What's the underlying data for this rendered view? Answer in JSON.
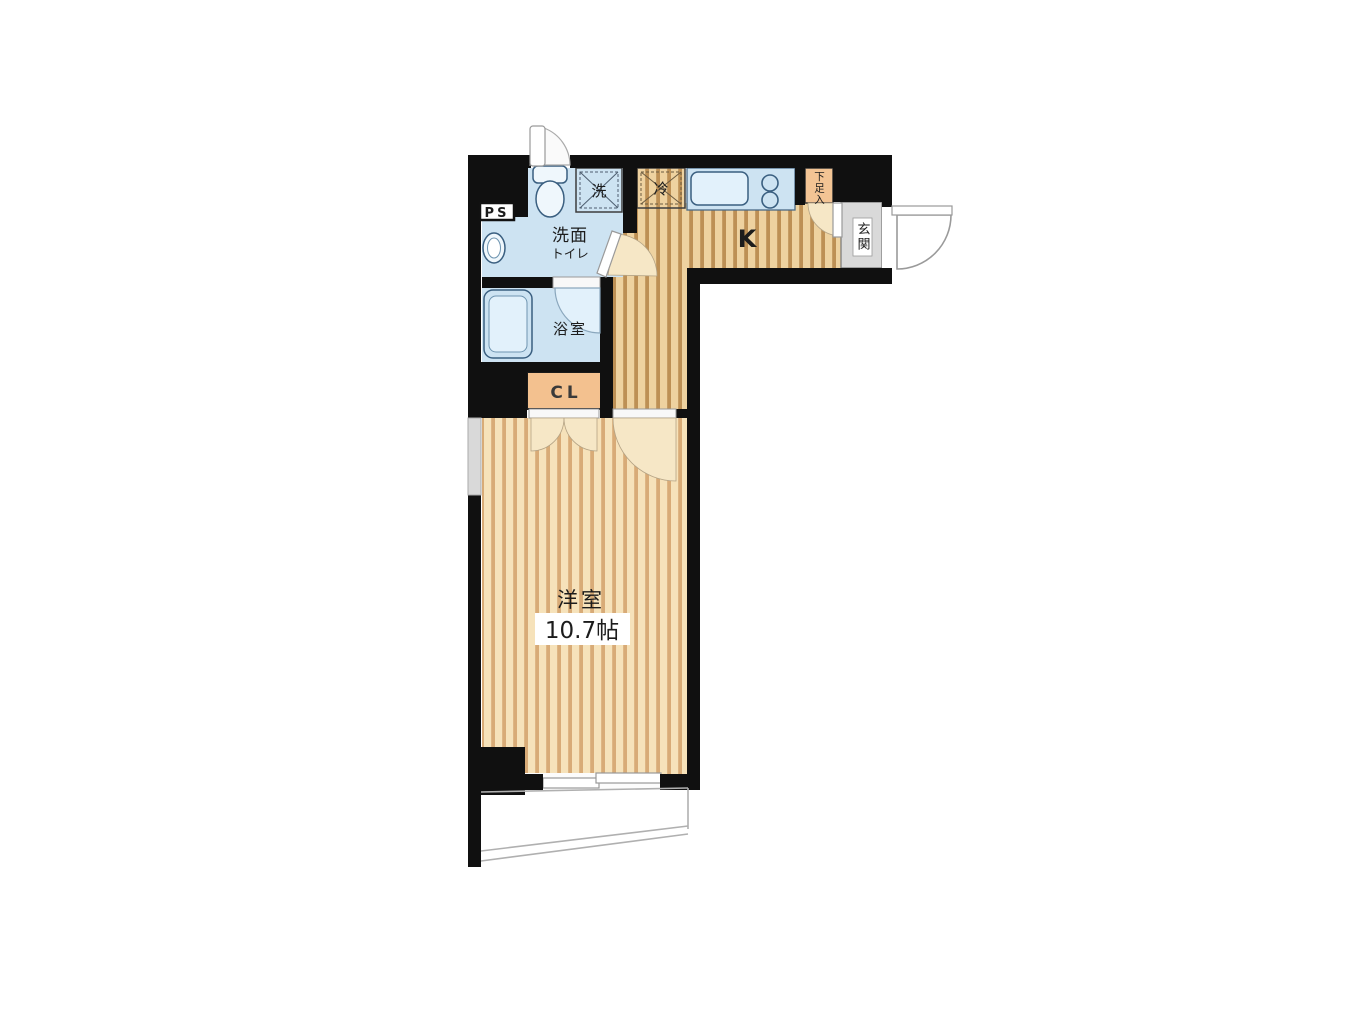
{
  "floorplan": {
    "type": "japanese-apartment-floor-plan",
    "labels": {
      "ps": "PS",
      "washroom_name": "洗面",
      "washroom_sub": "トイレ",
      "washer": "洗",
      "fridge": "冷",
      "kitchen": "K",
      "shoe_cabinet": "下足入",
      "entrance": "玄関",
      "bathroom": "浴室",
      "closet": "CL",
      "main_room": "洋室",
      "main_room_size": "10.7帖"
    },
    "colors": {
      "wall": "#101010",
      "water_area": "#cde3f2",
      "fixture_fill": "#eff7fc",
      "floor_room_base": "#f6e2ba",
      "floor_room_stripe": "#d8ab77",
      "floor_hall_base": "#eed2a0",
      "floor_hall_stripe": "#bd9055",
      "closet_orange": "#f3c18f",
      "shoe_cabinet_orange": "#f3c494",
      "entrance_gray": "#d9d9d9",
      "window_gray": "#d9d9d9",
      "door_arc_gray": "#9a9a9a",
      "background": "#ffffff"
    }
  }
}
